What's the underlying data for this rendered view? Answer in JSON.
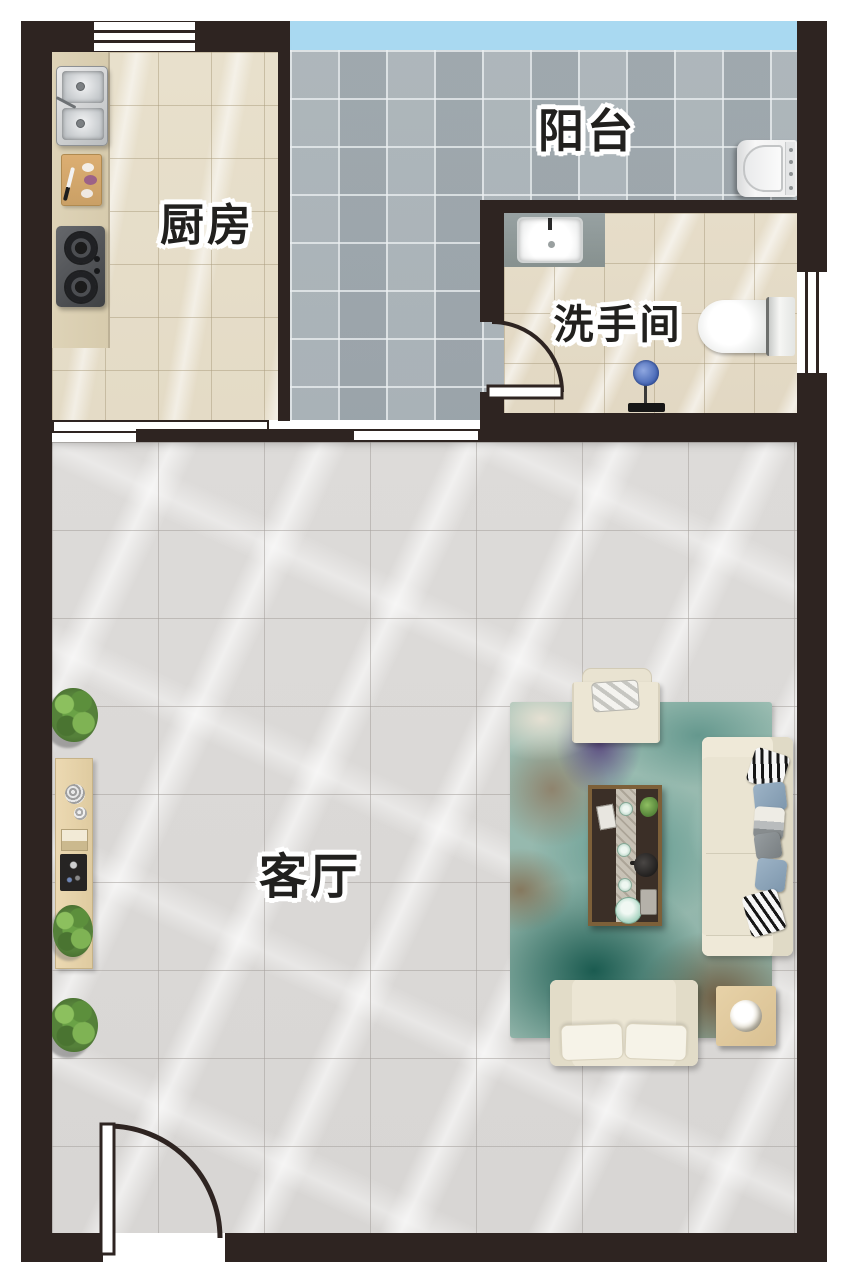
{
  "title": "户型平面图",
  "rooms": {
    "kitchen": {
      "label": "厨房"
    },
    "balcony": {
      "label": "阳台"
    },
    "bathroom": {
      "label": "洗手间"
    },
    "living_room": {
      "label": "客厅"
    }
  },
  "fixtures": {
    "kitchen": [
      "double-sink",
      "cutting-board",
      "gas-stove",
      "counter"
    ],
    "balcony": [
      "washing-machine",
      "glazed-window"
    ],
    "bathroom": [
      "vanity-sink",
      "toilet",
      "shower",
      "window",
      "door"
    ],
    "living_room": [
      "armchair",
      "sofa",
      "loveseat",
      "coffee-table",
      "tea-set",
      "side-table",
      "console-table",
      "area-rug",
      "potted-plants",
      "entry-door"
    ]
  },
  "palette": {
    "wall": "#2e2421",
    "balcony_glass": "#a9d9f1",
    "kitchen_floor": "#e8e0cc",
    "balcony_floor": "#a9b2b7",
    "bathroom_floor": "#e6ddc9",
    "living_floor": "#dddbd9",
    "label_text": "#21201e",
    "label_outline": "#ffffff",
    "rug_teal": "#58948a",
    "rug_dark_teal": "#14564b",
    "sofa_cream": "#eae4d2",
    "wood_light": "#e7d2a8"
  }
}
